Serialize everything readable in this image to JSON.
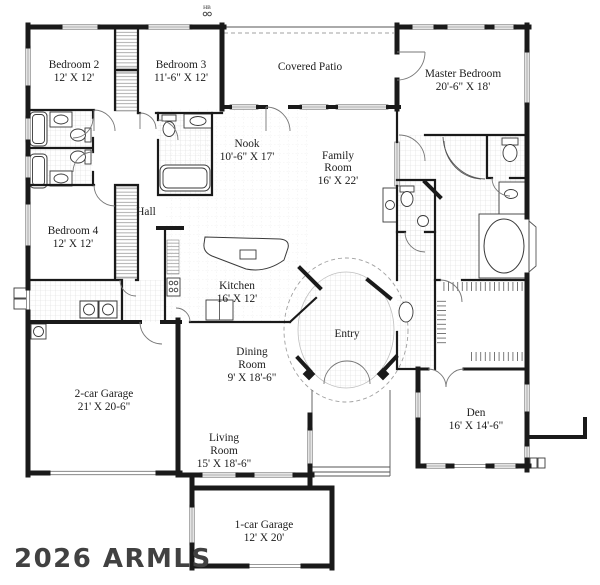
{
  "plan": {
    "watermark": "2026 ARMLS",
    "hose_bib": "HB",
    "colors": {
      "background": "#ffffff",
      "wall": "#1a1a1a",
      "thin_line": "#555555",
      "tile": "#d9d9d9",
      "watermark": "#414141"
    },
    "rooms": {
      "bedroom2": {
        "lines": [
          "Bedroom 2",
          "12' X 12'"
        ]
      },
      "bedroom3": {
        "lines": [
          "Bedroom 3",
          "11'-6\" X 12'"
        ]
      },
      "covered_patio": {
        "lines": [
          "Covered Patio"
        ]
      },
      "master_bedroom": {
        "lines": [
          "Master Bedroom",
          "20'-6\" X 18'"
        ]
      },
      "nook": {
        "lines": [
          "Nook",
          "10'-6\" X 17'"
        ]
      },
      "family_room": {
        "lines": [
          "Family",
          "Room",
          "16' X 22'"
        ]
      },
      "hall": {
        "lines": [
          "Hall"
        ]
      },
      "bedroom4": {
        "lines": [
          "Bedroom 4",
          "12' X 12'"
        ]
      },
      "kitchen": {
        "lines": [
          "Kitchen",
          "16' X 12'"
        ]
      },
      "entry": {
        "lines": [
          "Entry"
        ]
      },
      "dining_room": {
        "lines": [
          "Dining",
          "Room",
          "9' X 18'-6\""
        ]
      },
      "garage2": {
        "lines": [
          "2-car Garage",
          "21' X 20-6\""
        ]
      },
      "den": {
        "lines": [
          "Den",
          "16' X 14'-6\""
        ]
      },
      "living_room": {
        "lines": [
          "Living",
          "Room",
          "15' X 18'-6\""
        ]
      },
      "garage1": {
        "lines": [
          "1-car Garage",
          "12' X 20'"
        ]
      }
    }
  }
}
